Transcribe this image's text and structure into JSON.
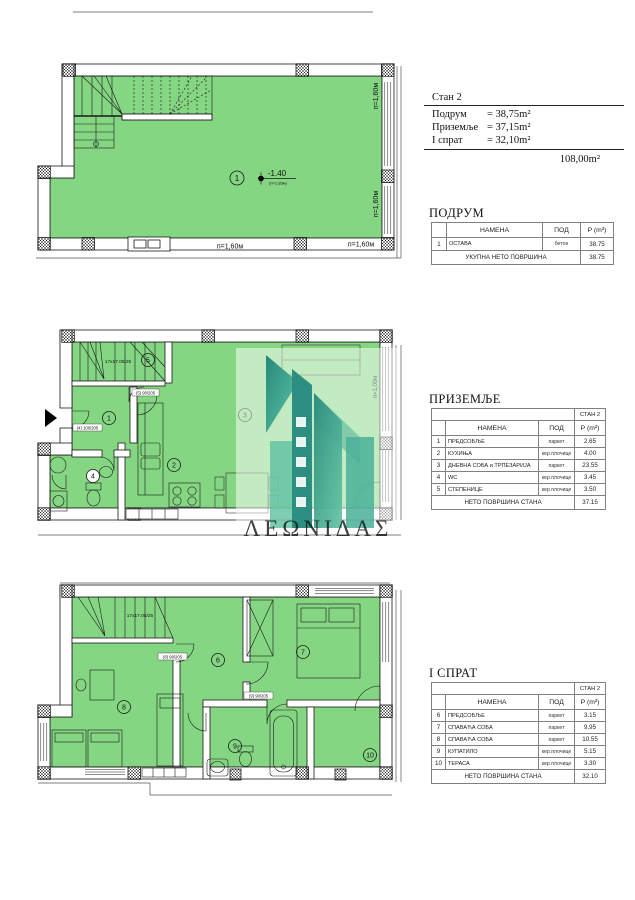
{
  "colors": {
    "floor_green": "#84d683",
    "wall_line": "#1a1a1a",
    "watermark_teal": "#2f9e8d"
  },
  "summary": {
    "title": "Стан 2",
    "rows": [
      {
        "label": "Подрум",
        "value": "= 38,75m²"
      },
      {
        "label": "Приземље",
        "value": "= 37,15m²"
      },
      {
        "label": "I спрат",
        "value": "= 32,10m²"
      }
    ],
    "total": "108,00m²"
  },
  "tables": {
    "podrum": {
      "title": "ПОДРУМ",
      "headers": {
        "num": "",
        "name": "НАМЕНА",
        "floor": "ПОД",
        "area": "P (m²)"
      },
      "rows": [
        {
          "num": "1",
          "name": "ОСТАВА",
          "floor": "бетон",
          "area": "38.75"
        }
      ],
      "footer": {
        "label": "УКУПНА НЕТО ПОВРШИНА",
        "value": "38.75"
      }
    },
    "prizemlje": {
      "title": "ПРИЗЕМЉЕ",
      "stan": "СТАН 2",
      "headers": {
        "num": "",
        "name": "НАМЕНА",
        "floor": "ПОД",
        "area": "P (m²)"
      },
      "rows": [
        {
          "num": "1",
          "name": "ПРЕДСОБЉЕ",
          "floor": "паркет",
          "area": "2.65"
        },
        {
          "num": "2",
          "name": "КУХИЊА",
          "floor": "кер.плочице",
          "area": "4.00"
        },
        {
          "num": "3",
          "name": "ДНЕВНА СОБА и ТРПЕЗАРИЈА",
          "floor": "паркет",
          "area": "23.55"
        },
        {
          "num": "4",
          "name": "WC",
          "floor": "кер.плочице",
          "area": "3.45"
        },
        {
          "num": "5",
          "name": "СТЕПЕНИЦЕ",
          "floor": "кер.плочице",
          "area": "3.50"
        }
      ],
      "footer": {
        "label": "НЕТО ПОВРШИНА СТАНА",
        "value": "37.15"
      }
    },
    "sprat": {
      "title": "I СПРАТ",
      "stan": "СТАН 2",
      "headers": {
        "num": "",
        "name": "НАМЕНА",
        "floor": "ПОД",
        "area": "P (m²)"
      },
      "rows": [
        {
          "num": "6",
          "name": "ПРЕДСОБЉЕ",
          "floor": "паркет",
          "area": "3.15"
        },
        {
          "num": "7",
          "name": "СПАВАЋА СОБА",
          "floor": "паркет",
          "area": "9.95"
        },
        {
          "num": "8",
          "name": "СПАВАЋА СОБА",
          "floor": "паркет",
          "area": "10.55"
        },
        {
          "num": "9",
          "name": "КУПАТИЛО",
          "floor": "кер.плочице",
          "area": "5.15"
        },
        {
          "num": "10",
          "name": "ТЕРАСА",
          "floor": "кер.плочице",
          "area": "3.30"
        }
      ],
      "footer": {
        "label": "НЕТО ПОВРШИНА СТАНА",
        "value": "32.10"
      }
    }
  },
  "plans": {
    "basement": {
      "room_labels": [
        "1"
      ],
      "level_marker": "-1.40",
      "level_note": "(h=2,85м)",
      "dims": [
        "п=1,60м",
        "п=1,60м",
        "п=1,60м",
        "п=1,60м"
      ]
    },
    "ground": {
      "room_labels": [
        "1",
        "2",
        "3",
        "4",
        "5"
      ],
      "stairs_label": "17x17.05/25",
      "door_entry": "(4) 100/205",
      "door_stairs": "(5) 90/205",
      "dim_right": "п=1,00м",
      "watermark_text": "ΛΕΩΝΙΔΑΣ"
    },
    "first": {
      "room_labels": [
        "6",
        "7",
        "8",
        "9",
        "10"
      ],
      "stairs_label": "17x17.05/25",
      "door_room8": "(8) 90/205",
      "door_bath": "(9) 90/205"
    }
  }
}
